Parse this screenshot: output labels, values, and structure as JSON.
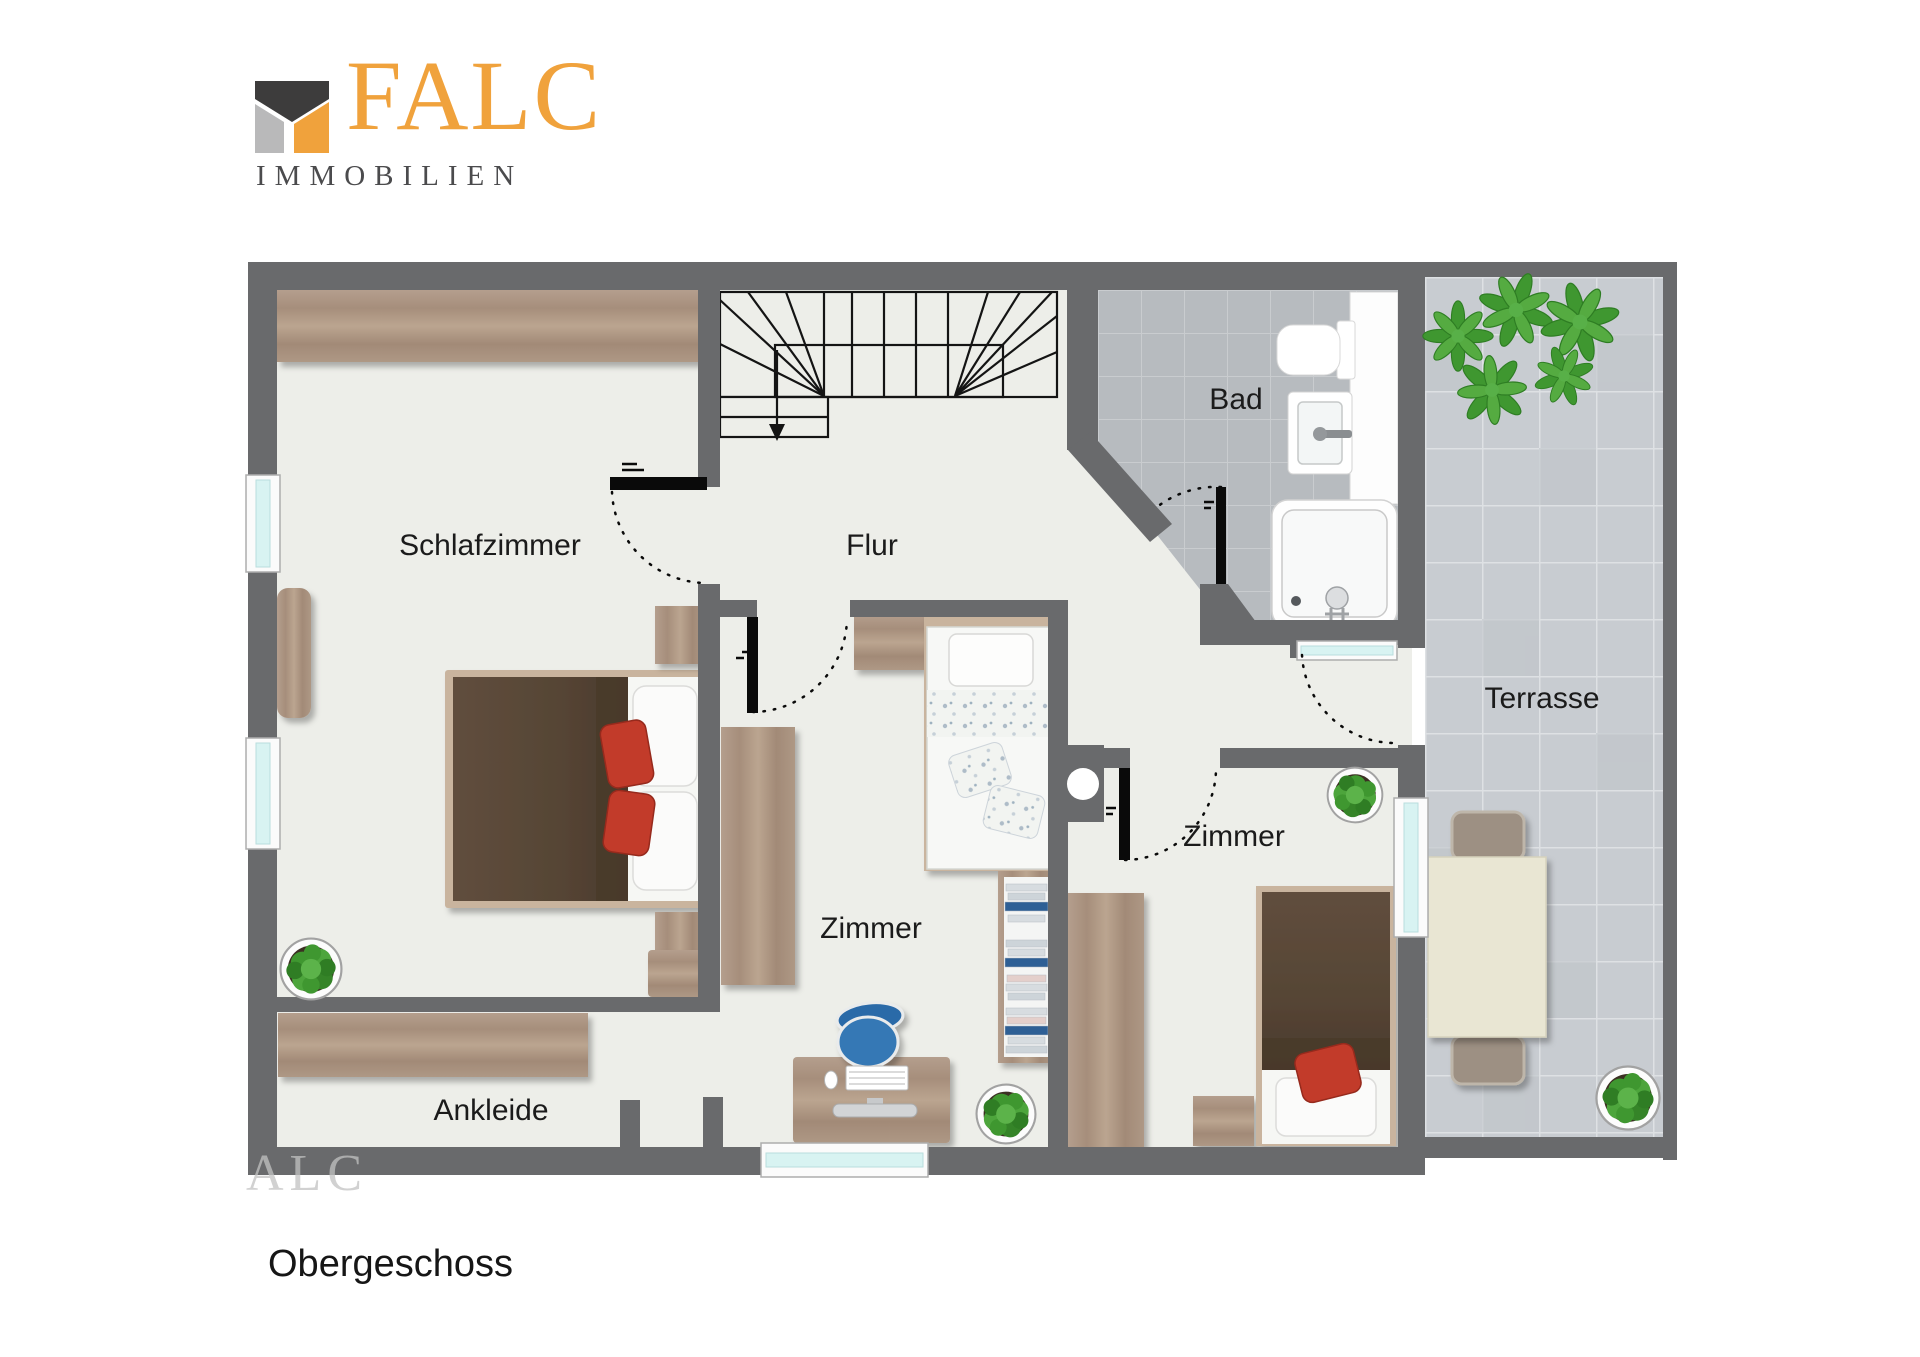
{
  "brand": {
    "name": "FALC",
    "subtitle": "IMMOBILIEN",
    "accent_color": "#F0A23C",
    "mark_dark": "#3D3C3C",
    "mark_gray": "#B9B9BA",
    "subtitle_color": "#4B4B4D"
  },
  "plan": {
    "floor_label": "Obergeschoss",
    "watermark": "ALC",
    "rooms": [
      {
        "id": "schlafzimmer",
        "label": "Schlafzimmer"
      },
      {
        "id": "flur",
        "label": "Flur"
      },
      {
        "id": "bad",
        "label": "Bad"
      },
      {
        "id": "zimmer-mitte",
        "label": "Zimmer"
      },
      {
        "id": "zimmer-rechts",
        "label": "Zimmer"
      },
      {
        "id": "ankleide",
        "label": "Ankleide"
      },
      {
        "id": "terrasse",
        "label": "Terrasse"
      }
    ],
    "colors": {
      "wall": "#696A6C",
      "floor": "#EDEEE9",
      "bath_tile": "#B7BBBF",
      "terrace_tile": "#C8CCD1",
      "wood": "#B19B8B",
      "bed_brown": "#5D4B3A",
      "pillow_red": "#C23B2C",
      "chair_blue": "#2F6FAD",
      "plant_green": "#46A235",
      "window_glass": "#D8F3F2"
    }
  }
}
